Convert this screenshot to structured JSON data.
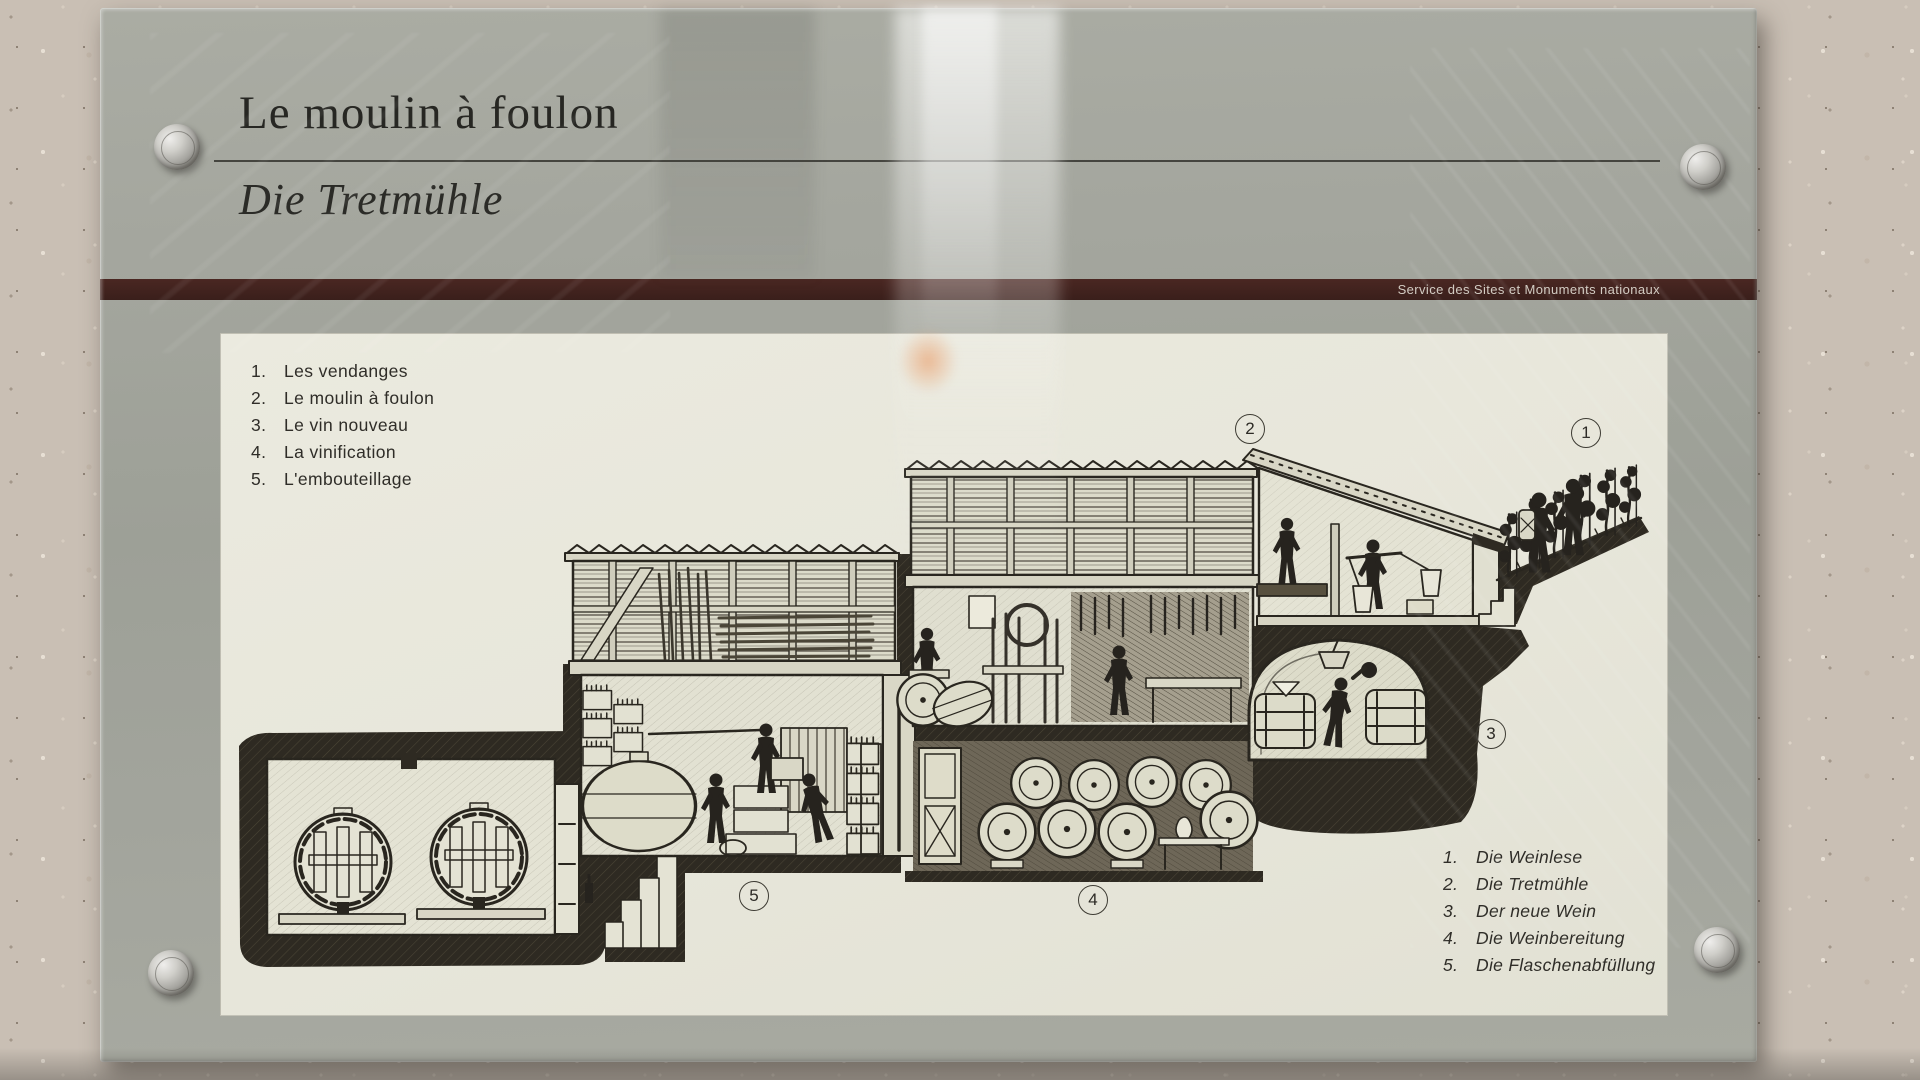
{
  "plaque": {
    "title_fr": "Le moulin à foulon",
    "title_de": "Die Tretmühle",
    "bar_caption": "Service des Sites et Monuments nationaux"
  },
  "legend_fr": {
    "items": [
      {
        "num": "1.",
        "label": "Les vendanges"
      },
      {
        "num": "2.",
        "label": "Le moulin à foulon"
      },
      {
        "num": "3.",
        "label": "Le vin nouveau"
      },
      {
        "num": "4.",
        "label": "La vinification"
      },
      {
        "num": "5.",
        "label": "L'embouteillage"
      }
    ]
  },
  "legend_de": {
    "items": [
      {
        "num": "1.",
        "label": "Die Weinlese"
      },
      {
        "num": "2.",
        "label": "Die Tretmühle"
      },
      {
        "num": "3.",
        "label": "Der neue Wein"
      },
      {
        "num": "4.",
        "label": "Die Weinbereitung"
      },
      {
        "num": "5.",
        "label": "Die Flaschenabfüllung"
      }
    ]
  },
  "markers": [
    {
      "label": "1"
    },
    {
      "label": "2"
    },
    {
      "label": "3"
    },
    {
      "label": "4"
    },
    {
      "label": "5"
    }
  ],
  "colors": {
    "bar_maroon": "#412420",
    "panel_cream": "#e7e6da",
    "ink": "#29261f",
    "glass_gray": "#a2a49c"
  }
}
